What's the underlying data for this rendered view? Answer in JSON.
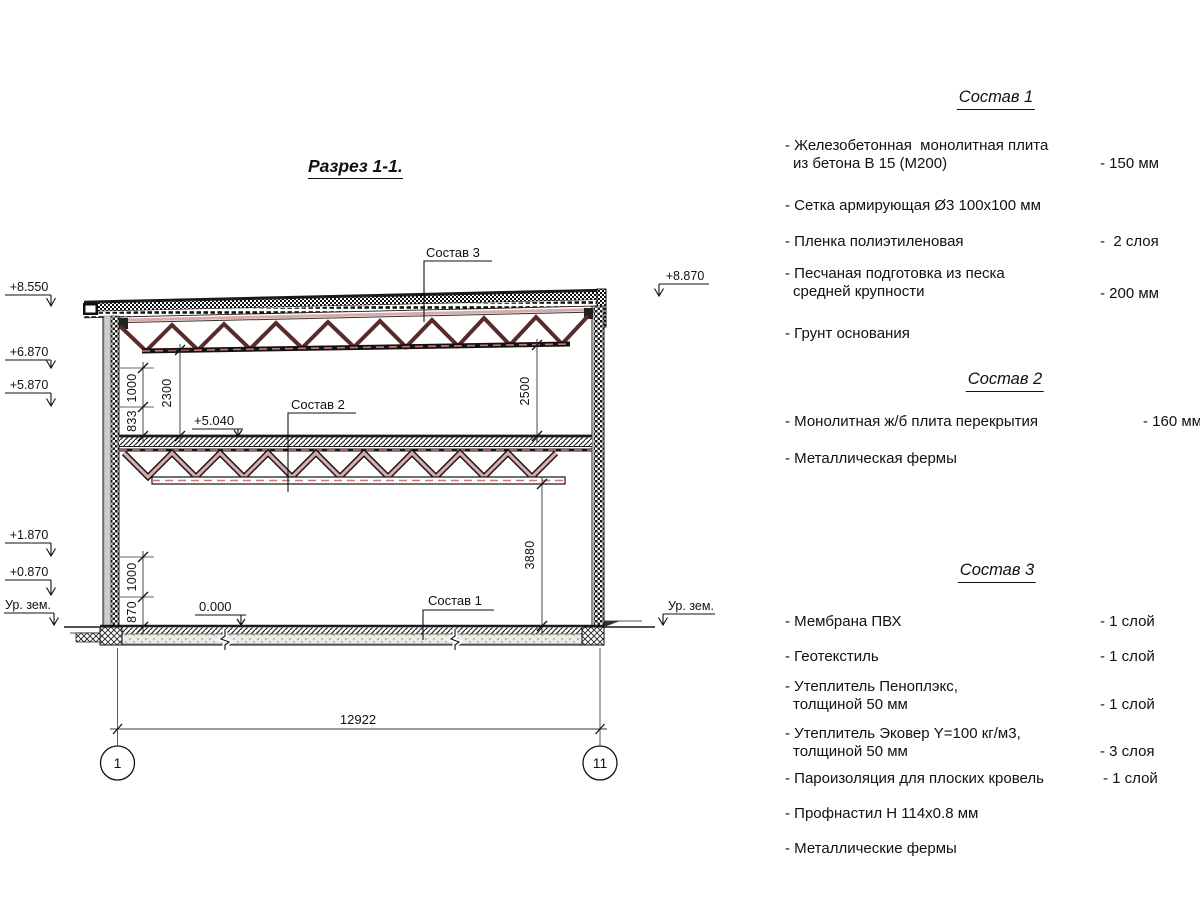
{
  "colors": {
    "ink": "#1a1a1a",
    "truss_dark": "#5a2b2b",
    "truss_pink": "#dca8a8",
    "centerline": "#cc7777"
  },
  "title": "Разрез 1-1.",
  "drawing": {
    "elevations": {
      "e8550": "+8.550",
      "e6870": "+6.870",
      "e5870": "+5.870",
      "e1870": "+1.870",
      "e0870": "+0.870",
      "e8870": "+8.870",
      "ground_left": "Ур. зем.",
      "ground_right": "Ур. зем."
    },
    "levels": {
      "l5040": "+5.040",
      "l0000": "0.000"
    },
    "leaders": {
      "sostav1": "Состав 1",
      "sostav2": "Состав 2",
      "sostav3": "Состав 3"
    },
    "dims": {
      "d2300": "2300",
      "d1000_upper": "1000",
      "d833": "833",
      "d2500": "2500",
      "d3880": "3880",
      "d1000_lower": "1000",
      "d870": "870",
      "d12922": "12922"
    },
    "axes": {
      "left": "1",
      "right": "11"
    }
  },
  "specs": {
    "s1": {
      "heading": "Состав 1",
      "items": [
        {
          "lines": [
            "- Железобетонная  монолитная плита",
            "из бетона В 15 (М200)"
          ],
          "value": "- 150 мм"
        },
        {
          "lines": [
            "- Сетка армирующая Ø3 100х100 мм"
          ]
        },
        {
          "lines": [
            "- Пленка полиэтиленовая"
          ],
          "value": "-  2 слоя"
        },
        {
          "lines": [
            "- Песчаная подготовка из песка",
            "средней крупности"
          ],
          "value": "- 200 мм"
        },
        {
          "lines": [
            "- Грунт основания"
          ]
        }
      ]
    },
    "s2": {
      "heading": "Состав 2",
      "items": [
        {
          "lines": [
            "- Монолитная ж/б плита перекрытия"
          ],
          "value": "- 160 мм"
        },
        {
          "lines": [
            "- Металлическая фермы"
          ]
        }
      ]
    },
    "s3": {
      "heading": "Состав 3",
      "items": [
        {
          "lines": [
            "- Мембрана ПВХ"
          ],
          "value": "- 1 слой"
        },
        {
          "lines": [
            "- Геотекстиль"
          ],
          "value": "- 1 слой"
        },
        {
          "lines": [
            "- Утеплитель Пеноплэкс,",
            "толщиной 50 мм"
          ],
          "value": "- 1 слой"
        },
        {
          "lines": [
            "- Утеплитель Эковер Y=100 кг/м3,",
            "толщиной 50 мм"
          ],
          "value": "- 3 слоя"
        },
        {
          "lines": [
            "- Пароизоляция для плоских кровель"
          ],
          "value": "- 1 слой"
        },
        {
          "lines": [
            "- Профнастил Н 114х0.8 мм"
          ]
        },
        {
          "lines": [
            "- Металлические фермы"
          ]
        }
      ]
    }
  }
}
